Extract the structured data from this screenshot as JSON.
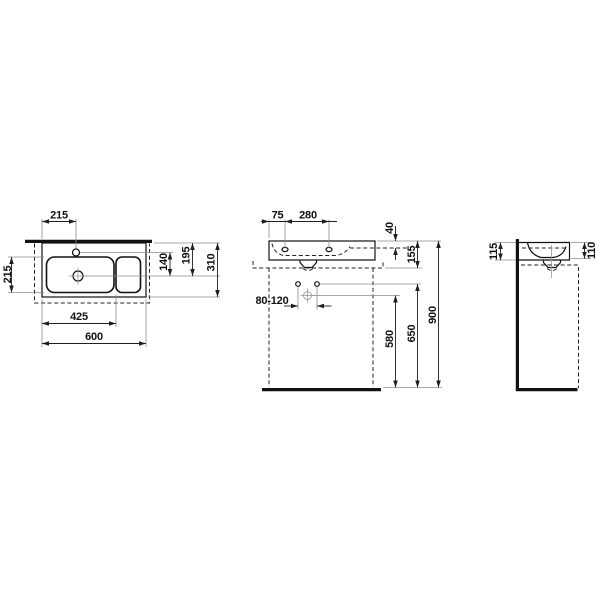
{
  "drawing": {
    "background": "#ffffff",
    "line_color": "#111111",
    "views": {
      "top": {
        "dims": {
          "tap_from_left": "215",
          "bowl_front_to_back": "215",
          "tap_to_drain": "140",
          "rim_to_drain": "195",
          "depth_total": "310",
          "bowl_zone_width": "425",
          "width_total": "600"
        }
      },
      "front": {
        "dims": {
          "edge_to_hole": "75",
          "hole_to_hole": "280",
          "rim_to_shelf": "40",
          "body_height": "155",
          "waste_offset_range": "80-120",
          "waste_height": "580",
          "fixing_height": "650",
          "rim_height": "900"
        }
      },
      "side": {
        "dims": {
          "height_at_wall": "115",
          "height_at_front": "110"
        }
      }
    }
  }
}
